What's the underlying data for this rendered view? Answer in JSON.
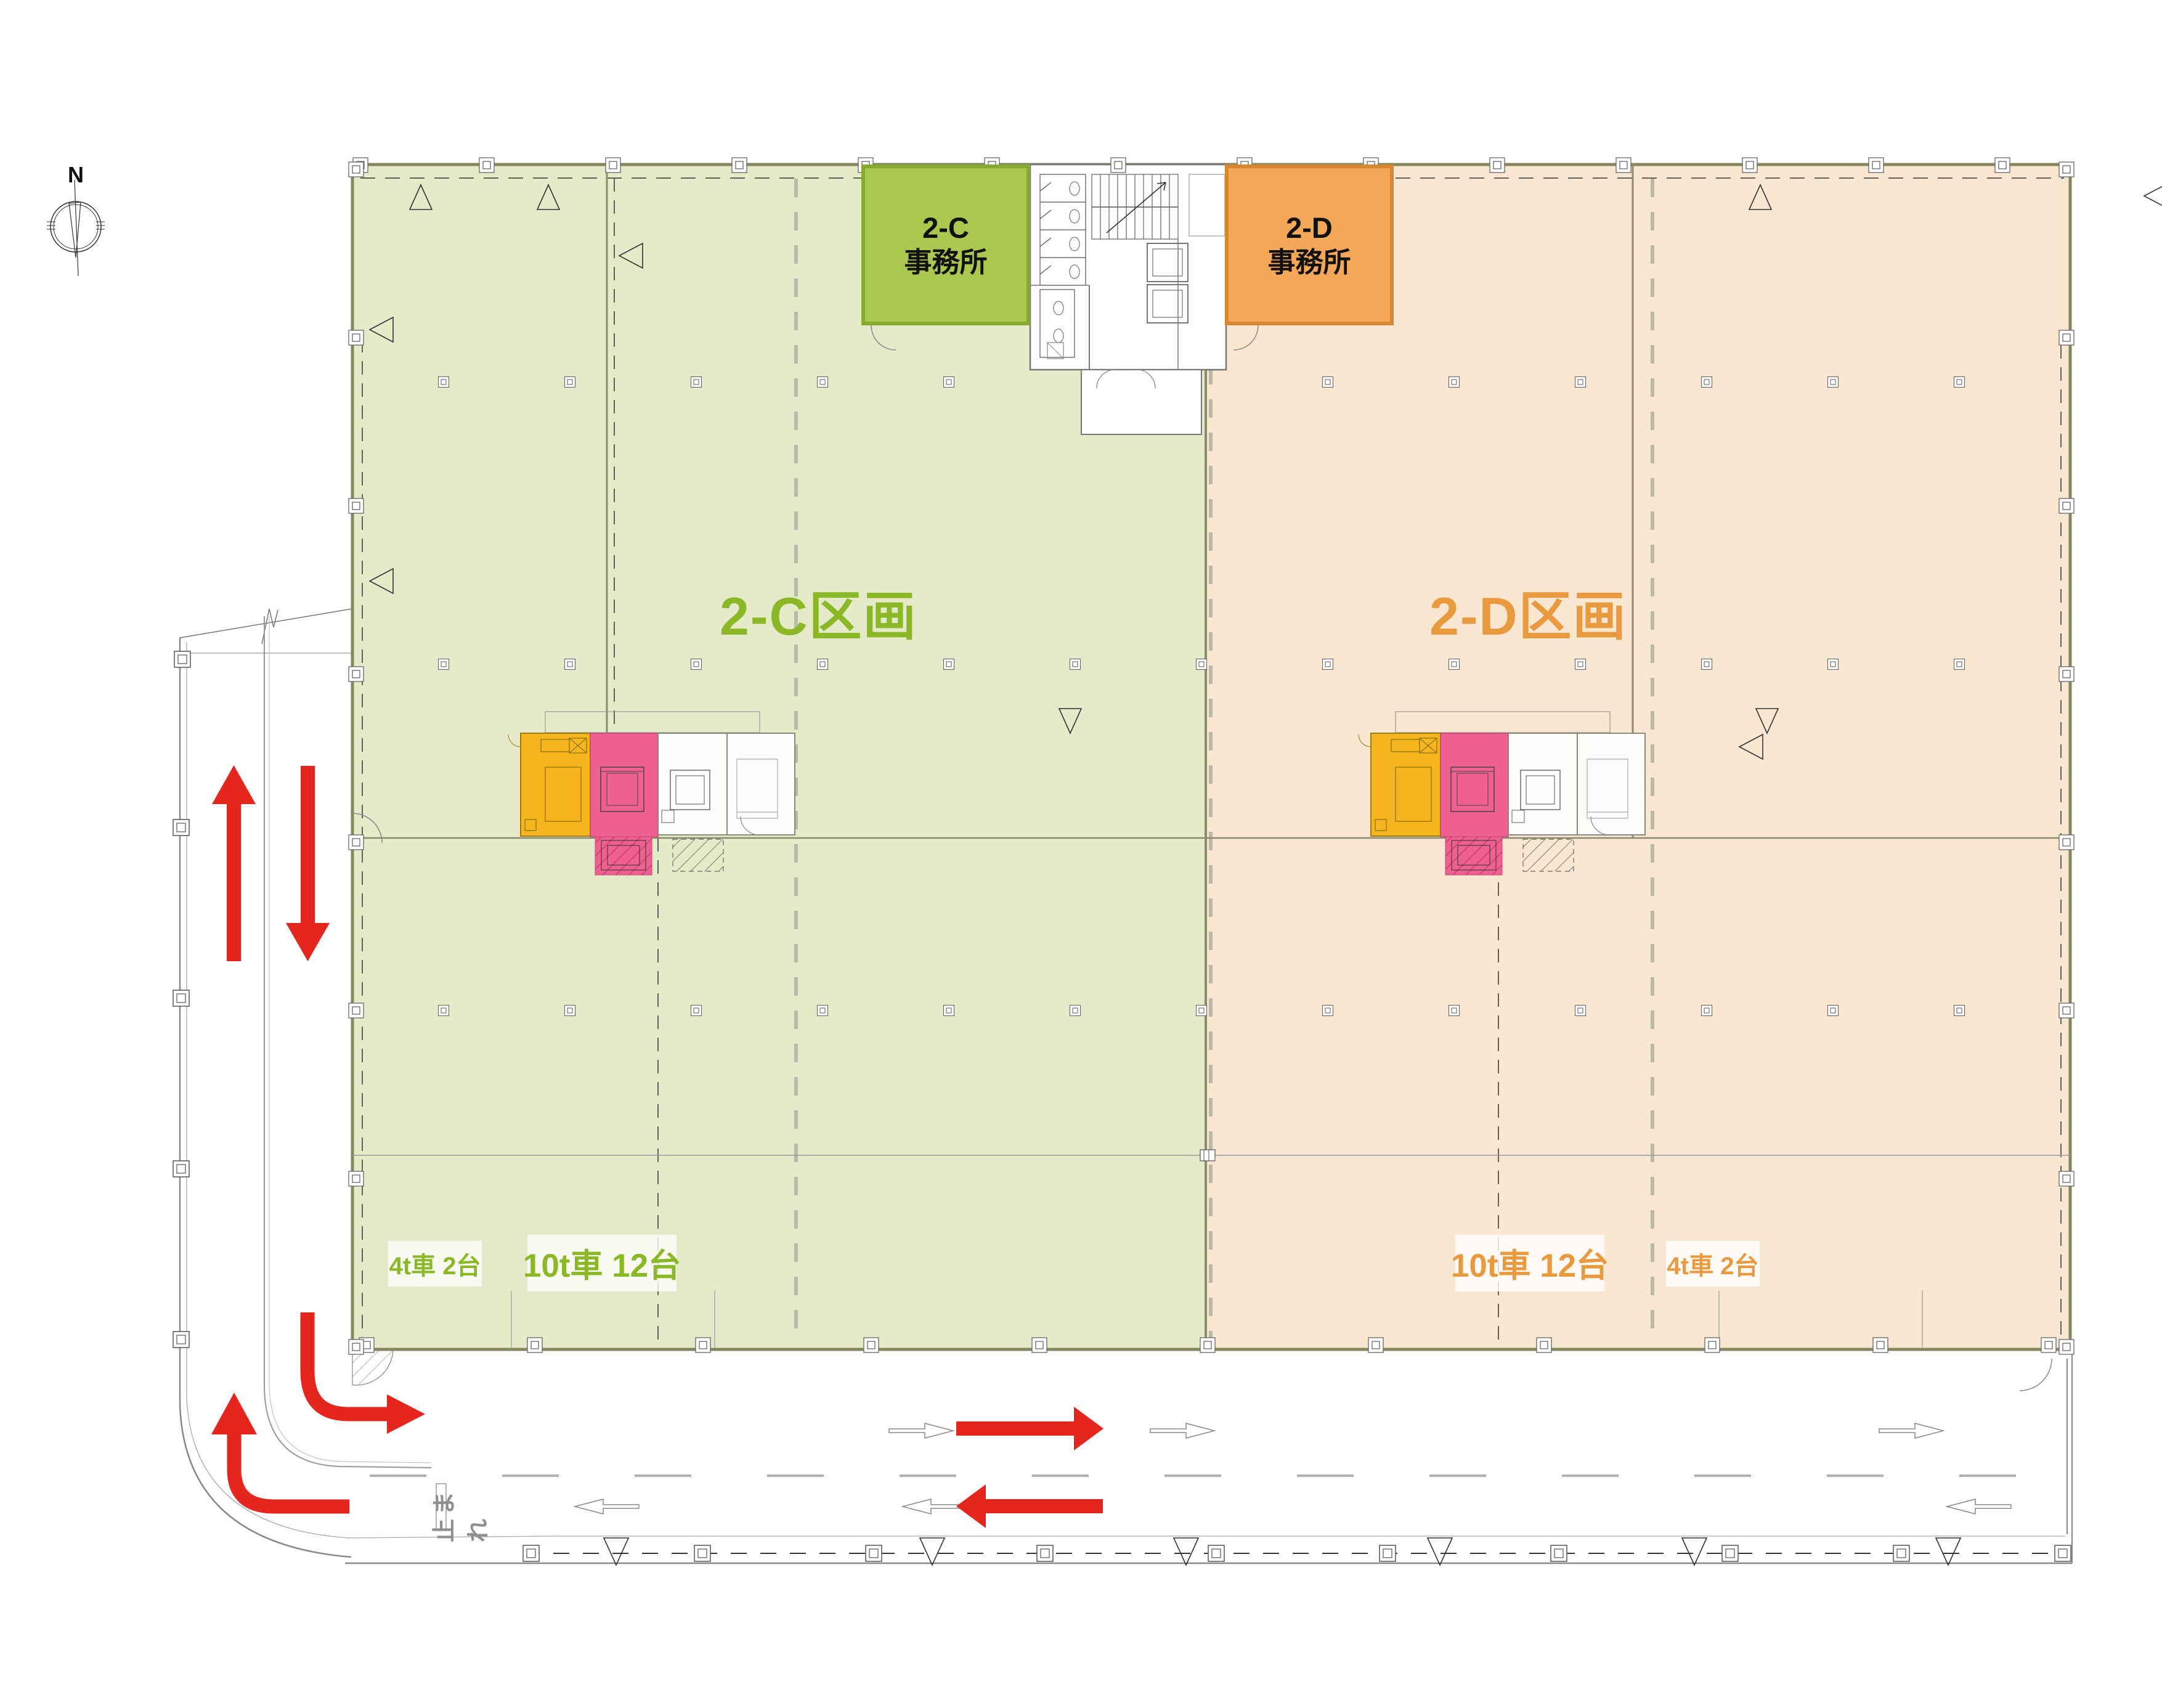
{
  "compass": {
    "label": "N"
  },
  "sections": {
    "c": {
      "name": "2-C区画",
      "office": [
        "2-C",
        "事務所"
      ],
      "parking": [
        {
          "label": "4t車 2台"
        },
        {
          "label": "10t車 12台"
        }
      ],
      "accent_color": "#8bb827",
      "fill_color": "#e5ebc8",
      "office_fill": "#abc74e"
    },
    "d": {
      "name": "2-D区画",
      "office": [
        "2-D",
        "事務所"
      ],
      "parking": [
        {
          "label": "10t車 12台"
        },
        {
          "label": "4t車 2台"
        }
      ],
      "accent_color": "#ea9a3e",
      "fill_color": "#fae7d2",
      "office_fill": "#f3a757"
    }
  },
  "road": {
    "stop_marking": "止まれ"
  },
  "flow_colors": {
    "arrow_red": "#e5261f",
    "lift_pink": "#ef5f90",
    "machine_yellow": "#f6b51f"
  }
}
